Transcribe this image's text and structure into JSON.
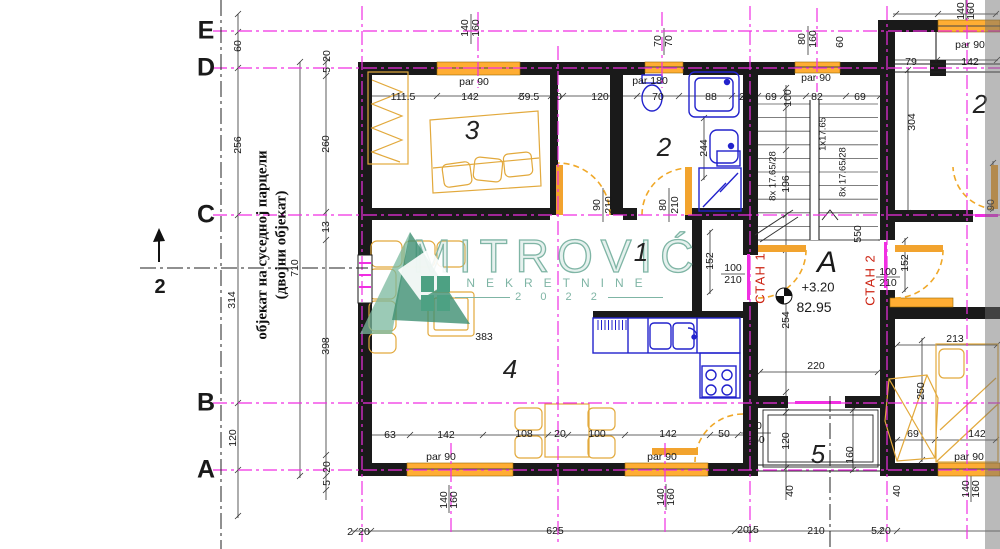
{
  "watermark": {
    "name": "MITROVIĆ",
    "line2": "NEKRETNINE",
    "year": "2 0 2 2"
  },
  "plan": {
    "type": "architectural floor plan",
    "side_note": {
      "line1": "објекат на суседној парцели",
      "line2": "(двојни објекат)"
    },
    "section_mark": {
      "label": "2"
    },
    "grid_letters": [
      {
        "t": "E",
        "x": 206,
        "y": 31
      },
      {
        "t": "D",
        "x": 206,
        "y": 68
      },
      {
        "t": "C",
        "x": 206,
        "y": 215
      },
      {
        "t": "B",
        "x": 206,
        "y": 403
      },
      {
        "t": "A",
        "x": 206,
        "y": 470
      }
    ],
    "rooms": [
      {
        "t": "3",
        "x": 472,
        "y": 130
      },
      {
        "t": "2",
        "x": 664,
        "y": 147
      },
      {
        "t": "1",
        "x": 641,
        "y": 252
      },
      {
        "t": "4",
        "x": 510,
        "y": 369
      },
      {
        "t": "5",
        "x": 818,
        "y": 454
      },
      {
        "t": "2",
        "x": 980,
        "y": 104
      }
    ],
    "apartments": [
      {
        "t": "СТАН 1",
        "x": 760,
        "y": 278
      },
      {
        "t": "СТАН 2",
        "x": 870,
        "y": 280
      }
    ],
    "unit": {
      "name": "А",
      "level": "+3.20",
      "area": "82.95"
    },
    "dims": [
      {
        "t": "60",
        "x": 238,
        "y": 46,
        "r": 1
      },
      {
        "t": "20",
        "x": 327,
        "y": 56,
        "r": 1
      },
      {
        "t": "5",
        "x": 327,
        "y": 70,
        "r": 1
      },
      {
        "t": "140",
        "x": 465,
        "y": 28,
        "r": 1
      },
      {
        "t": "160",
        "x": 476,
        "y": 28,
        "r": 1
      },
      {
        "t": "par 90",
        "x": 474,
        "y": 82
      },
      {
        "t": "111.5",
        "x": 403,
        "y": 97
      },
      {
        "t": "142",
        "x": 470,
        "y": 97
      },
      {
        "t": "59.5",
        "x": 529,
        "y": 97
      },
      {
        "t": "20",
        "x": 556,
        "y": 97
      },
      {
        "t": "120",
        "x": 600,
        "y": 97
      },
      {
        "t": "70",
        "x": 658,
        "y": 97
      },
      {
        "t": "88",
        "x": 711,
        "y": 97
      },
      {
        "t": "20",
        "x": 745,
        "y": 97
      },
      {
        "t": "69",
        "x": 771,
        "y": 97
      },
      {
        "t": "100",
        "x": 788,
        "y": 98,
        "r": 1
      },
      {
        "t": "82",
        "x": 817,
        "y": 97
      },
      {
        "t": "69",
        "x": 860,
        "y": 97
      },
      {
        "t": "par 180",
        "x": 650,
        "y": 81
      },
      {
        "t": "70",
        "x": 658,
        "y": 41,
        "r": 1
      },
      {
        "t": "70",
        "x": 669,
        "y": 41,
        "r": 1
      },
      {
        "t": "80",
        "x": 802,
        "y": 39,
        "r": 1
      },
      {
        "t": "160",
        "x": 813,
        "y": 39,
        "r": 1
      },
      {
        "t": "60",
        "x": 840,
        "y": 42,
        "r": 1
      },
      {
        "t": "par 90",
        "x": 816,
        "y": 78
      },
      {
        "t": "79",
        "x": 911,
        "y": 62
      },
      {
        "t": "142",
        "x": 970,
        "y": 62
      },
      {
        "t": "par 90",
        "x": 970,
        "y": 45
      },
      {
        "t": "140",
        "x": 961,
        "y": 11,
        "r": 1
      },
      {
        "t": "160",
        "x": 971,
        "y": 11,
        "r": 1
      },
      {
        "t": "304",
        "x": 912,
        "y": 122,
        "r": 1
      },
      {
        "t": "256",
        "x": 238,
        "y": 145,
        "r": 1
      },
      {
        "t": "314",
        "x": 232,
        "y": 300,
        "r": 1
      },
      {
        "t": "120",
        "x": 233,
        "y": 438,
        "r": 1
      },
      {
        "t": "710",
        "x": 295,
        "y": 268,
        "r": 1
      },
      {
        "t": "260",
        "x": 326,
        "y": 144,
        "r": 1
      },
      {
        "t": "13",
        "x": 326,
        "y": 227,
        "r": 1
      },
      {
        "t": "398",
        "x": 326,
        "y": 346,
        "r": 1
      },
      {
        "t": "20",
        "x": 327,
        "y": 467,
        "r": 1
      },
      {
        "t": "5",
        "x": 327,
        "y": 483,
        "r": 1
      },
      {
        "t": "90",
        "x": 597,
        "y": 205,
        "r": 1
      },
      {
        "t": "210",
        "x": 609,
        "y": 205,
        "r": 1
      },
      {
        "t": "80",
        "x": 663,
        "y": 205,
        "r": 1
      },
      {
        "t": "210",
        "x": 675,
        "y": 205,
        "r": 1
      },
      {
        "t": "244",
        "x": 704,
        "y": 148,
        "r": 1
      },
      {
        "t": "152",
        "x": 710,
        "y": 261,
        "r": 1
      },
      {
        "t": "100",
        "x": 733,
        "y": 268
      },
      {
        "t": "210",
        "x": 733,
        "y": 280
      },
      {
        "t": "383",
        "x": 484,
        "y": 337
      },
      {
        "t": "196",
        "x": 786,
        "y": 184,
        "r": 1
      },
      {
        "t": "8x 17.65/28",
        "x": 773,
        "y": 176,
        "r": 1,
        "fs": 9.5
      },
      {
        "t": "1x17.65",
        "x": 823,
        "y": 134,
        "r": 1,
        "fs": 9.5
      },
      {
        "t": "8x 17.65/28",
        "x": 843,
        "y": 172,
        "r": 1,
        "fs": 9.5
      },
      {
        "t": "550",
        "x": 858,
        "y": 234,
        "r": 1
      },
      {
        "t": "254",
        "x": 786,
        "y": 320,
        "r": 1
      },
      {
        "t": "220",
        "x": 816,
        "y": 366
      },
      {
        "t": "100",
        "x": 888,
        "y": 272
      },
      {
        "t": "210",
        "x": 888,
        "y": 283
      },
      {
        "t": "152",
        "x": 905,
        "y": 263,
        "r": 1
      },
      {
        "t": "90",
        "x": 991,
        "y": 205,
        "r": 1
      },
      {
        "t": "213",
        "x": 955,
        "y": 339
      },
      {
        "t": "250",
        "x": 921,
        "y": 391,
        "r": 1
      },
      {
        "t": "63",
        "x": 390,
        "y": 435
      },
      {
        "t": "142",
        "x": 446,
        "y": 435
      },
      {
        "t": "108",
        "x": 524,
        "y": 434
      },
      {
        "t": "20",
        "x": 560,
        "y": 434
      },
      {
        "t": "100",
        "x": 597,
        "y": 434
      },
      {
        "t": "142",
        "x": 668,
        "y": 434
      },
      {
        "t": "50",
        "x": 724,
        "y": 434
      },
      {
        "t": "80",
        "x": 756,
        "y": 426
      },
      {
        "t": "250",
        "x": 756,
        "y": 440
      },
      {
        "t": "120",
        "x": 786,
        "y": 441,
        "r": 1
      },
      {
        "t": "160",
        "x": 850,
        "y": 455,
        "r": 1
      },
      {
        "t": "40",
        "x": 790,
        "y": 491,
        "r": 1
      },
      {
        "t": "40",
        "x": 897,
        "y": 491,
        "r": 1
      },
      {
        "t": "69",
        "x": 913,
        "y": 434
      },
      {
        "t": "142",
        "x": 977,
        "y": 434
      },
      {
        "t": "par 90",
        "x": 969,
        "y": 457
      },
      {
        "t": "140",
        "x": 966,
        "y": 489,
        "r": 1
      },
      {
        "t": "160",
        "x": 976,
        "y": 489,
        "r": 1
      },
      {
        "t": "par 90",
        "x": 441,
        "y": 457
      },
      {
        "t": "140",
        "x": 444,
        "y": 500,
        "r": 1
      },
      {
        "t": "160",
        "x": 454,
        "y": 500,
        "r": 1
      },
      {
        "t": "par 90",
        "x": 662,
        "y": 457
      },
      {
        "t": "140",
        "x": 661,
        "y": 497,
        "r": 1
      },
      {
        "t": "160",
        "x": 671,
        "y": 497,
        "r": 1
      },
      {
        "t": "2",
        "x": 350,
        "y": 532
      },
      {
        "t": "20",
        "x": 364,
        "y": 532
      },
      {
        "t": "625",
        "x": 555,
        "y": 531
      },
      {
        "t": "20",
        "x": 743,
        "y": 530
      },
      {
        "t": "15",
        "x": 753,
        "y": 530
      },
      {
        "t": "210",
        "x": 816,
        "y": 531
      },
      {
        "t": "5",
        "x": 874,
        "y": 531
      },
      {
        "t": "20",
        "x": 885,
        "y": 531
      }
    ]
  },
  "colors": {
    "axis_magenta": "#f02fe2",
    "wall_black": "#1a1a1a",
    "window_orange": "#ffad33",
    "furniture_yellow": "#e2a93c",
    "fixture_blue": "#2222cc",
    "door_orange": "#f0a828",
    "watermark_teal": "#7fb5a5",
    "apartment_red": "#cc2211"
  }
}
